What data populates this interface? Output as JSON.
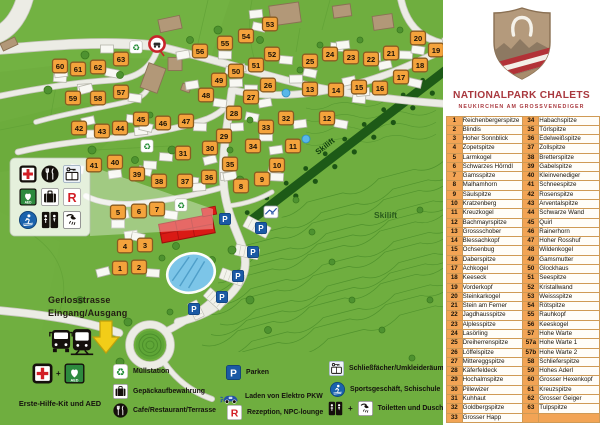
{
  "panel": {
    "title": "NATIONALPARK CHALETS",
    "subtitle": "NEUKIRCHEN AM GROSSVENEDIGER",
    "chalet_table": {
      "rows": [
        [
          "1",
          "Reichenbergerspitze",
          "34",
          "Habachspitze"
        ],
        [
          "2",
          "Blindis",
          "35",
          "Törlspitze"
        ],
        [
          "3",
          "Hoher Sonnblick",
          "36",
          "Edelweißspitze"
        ],
        [
          "4",
          "Zopetspitze",
          "37",
          "Zollspitze"
        ],
        [
          "5",
          "Larmkogel",
          "38",
          "Bretterspitze"
        ],
        [
          "6",
          "Schwarzes Hörndl",
          "39",
          "Gabelspitze"
        ],
        [
          "7",
          "Gamsspitze",
          "40",
          "Kleinvenediger"
        ],
        [
          "8",
          "Malhamhorn",
          "41",
          "Schneespitze"
        ],
        [
          "9",
          "Säulspitze",
          "42",
          "Rosenspitze"
        ],
        [
          "10",
          "Kratzenberg",
          "43",
          "Arventalspitze"
        ],
        [
          "11",
          "Kreuzkogel",
          "44",
          "Schwarze Wand"
        ],
        [
          "12",
          "Bachmayrspitze",
          "45",
          "Quirl"
        ],
        [
          "13",
          "Grossschober",
          "46",
          "Rainerhorn"
        ],
        [
          "14",
          "Blessachkopf",
          "47",
          "Hoher Rosshuf"
        ],
        [
          "15",
          "Ochsenbug",
          "48",
          "Wildenkogel"
        ],
        [
          "16",
          "Daberspitze",
          "49",
          "Gamsmutter"
        ],
        [
          "17",
          "Achkogel",
          "50",
          "Glockhaus"
        ],
        [
          "18",
          "Keeseck",
          "51",
          "Seespitze"
        ],
        [
          "19",
          "Vorderkopf",
          "52",
          "Kristallwand"
        ],
        [
          "20",
          "Steinkarkogel",
          "53",
          "Weissspitze"
        ],
        [
          "21",
          "Stein am Ferner",
          "54",
          "Rötspitze"
        ],
        [
          "22",
          "Jagdhausspitze",
          "55",
          "Rauhkopf"
        ],
        [
          "23",
          "Alplesspitze",
          "56",
          "Keeskogel"
        ],
        [
          "24",
          "Lasörling",
          "57",
          "Hohe Warte"
        ],
        [
          "25",
          "Dreiherrenspitze",
          "57a",
          "Hohe Warte 1"
        ],
        [
          "26",
          "Löffelspitze",
          "57b",
          "Hohe Warte 2"
        ],
        [
          "27",
          "Mittereggspitze",
          "58",
          "Schlieferspitze"
        ],
        [
          "28",
          "Käferfeldeck",
          "59",
          "Hohes Aderl"
        ],
        [
          "29",
          "Hochalmspitze",
          "60",
          "Grosser Hexenkopf"
        ],
        [
          "30",
          "Pillewizer",
          "61",
          "Kreuzspitze"
        ],
        [
          "31",
          "Kuhhaut",
          "62",
          "Grosser Geiger"
        ],
        [
          "32",
          "Goldbergspitze",
          "63",
          "Tulpspitze"
        ],
        [
          "33",
          "Grosser Happ",
          "",
          ""
        ]
      ]
    }
  },
  "map": {
    "labels": {
      "street": "Gerlosstrasse",
      "entrance": "Eingang/Ausgang",
      "skilift_band": "Skilift",
      "skilift_hill": "Skilift"
    },
    "markers": [
      {
        "n": "1",
        "x": 120,
        "y": 268
      },
      {
        "n": "2",
        "x": 139,
        "y": 267
      },
      {
        "n": "3",
        "x": 145,
        "y": 245
      },
      {
        "n": "4",
        "x": 125,
        "y": 246
      },
      {
        "n": "5",
        "x": 118,
        "y": 212
      },
      {
        "n": "6",
        "x": 139,
        "y": 211
      },
      {
        "n": "7",
        "x": 157,
        "y": 209
      },
      {
        "n": "8",
        "x": 241,
        "y": 186
      },
      {
        "n": "9",
        "x": 262,
        "y": 179
      },
      {
        "n": "10",
        "x": 277,
        "y": 165
      },
      {
        "n": "11",
        "x": 293,
        "y": 146
      },
      {
        "n": "12",
        "x": 327,
        "y": 118
      },
      {
        "n": "13",
        "x": 310,
        "y": 89
      },
      {
        "n": "14",
        "x": 336,
        "y": 90
      },
      {
        "n": "15",
        "x": 359,
        "y": 87
      },
      {
        "n": "16",
        "x": 380,
        "y": 88
      },
      {
        "n": "17",
        "x": 401,
        "y": 77
      },
      {
        "n": "18",
        "x": 420,
        "y": 65
      },
      {
        "n": "19",
        "x": 436,
        "y": 50
      },
      {
        "n": "20",
        "x": 418,
        "y": 38
      },
      {
        "n": "21",
        "x": 391,
        "y": 53
      },
      {
        "n": "22",
        "x": 371,
        "y": 59
      },
      {
        "n": "23",
        "x": 351,
        "y": 57
      },
      {
        "n": "24",
        "x": 330,
        "y": 54
      },
      {
        "n": "25",
        "x": 310,
        "y": 61
      },
      {
        "n": "26",
        "x": 268,
        "y": 85
      },
      {
        "n": "27",
        "x": 251,
        "y": 97
      },
      {
        "n": "28",
        "x": 234,
        "y": 113
      },
      {
        "n": "29",
        "x": 224,
        "y": 136
      },
      {
        "n": "30",
        "x": 210,
        "y": 148
      },
      {
        "n": "31",
        "x": 183,
        "y": 153
      },
      {
        "n": "32",
        "x": 286,
        "y": 118
      },
      {
        "n": "33",
        "x": 266,
        "y": 127
      },
      {
        "n": "34",
        "x": 253,
        "y": 146
      },
      {
        "n": "35",
        "x": 230,
        "y": 164
      },
      {
        "n": "36",
        "x": 209,
        "y": 177
      },
      {
        "n": "37",
        "x": 185,
        "y": 181
      },
      {
        "n": "38",
        "x": 159,
        "y": 181
      },
      {
        "n": "39",
        "x": 137,
        "y": 174
      },
      {
        "n": "40",
        "x": 115,
        "y": 162
      },
      {
        "n": "41",
        "x": 94,
        "y": 165
      },
      {
        "n": "42",
        "x": 79,
        "y": 128
      },
      {
        "n": "43",
        "x": 102,
        "y": 131
      },
      {
        "n": "44",
        "x": 120,
        "y": 128
      },
      {
        "n": "45",
        "x": 141,
        "y": 119
      },
      {
        "n": "46",
        "x": 163,
        "y": 123
      },
      {
        "n": "47",
        "x": 186,
        "y": 121
      },
      {
        "n": "48",
        "x": 206,
        "y": 95
      },
      {
        "n": "49",
        "x": 219,
        "y": 80
      },
      {
        "n": "50",
        "x": 236,
        "y": 71
      },
      {
        "n": "51",
        "x": 256,
        "y": 65
      },
      {
        "n": "52",
        "x": 272,
        "y": 54
      },
      {
        "n": "53",
        "x": 270,
        "y": 24
      },
      {
        "n": "54",
        "x": 246,
        "y": 36
      },
      {
        "n": "55",
        "x": 225,
        "y": 43
      },
      {
        "n": "56",
        "x": 200,
        "y": 51
      },
      {
        "n": "57",
        "x": 121,
        "y": 92
      },
      {
        "n": "58",
        "x": 98,
        "y": 98
      },
      {
        "n": "59",
        "x": 73,
        "y": 98
      },
      {
        "n": "60",
        "x": 60,
        "y": 66
      },
      {
        "n": "61",
        "x": 78,
        "y": 69
      },
      {
        "n": "62",
        "x": 98,
        "y": 67
      },
      {
        "n": "63",
        "x": 121,
        "y": 59
      }
    ],
    "poi": {
      "recycle": [
        [
          136,
          47
        ],
        [
          147,
          146
        ],
        [
          181,
          205
        ]
      ],
      "parking": [
        [
          225,
          219
        ],
        [
          261,
          228
        ],
        [
          253,
          252
        ],
        [
          238,
          276
        ],
        [
          222,
          297
        ],
        [
          194,
          309
        ]
      ],
      "skilift_station": [
        271,
        212
      ],
      "traffic_sign": [
        157,
        44
      ],
      "bus": [
        61,
        341
      ],
      "train": [
        82,
        342
      ],
      "entrance_arrow": [
        106,
        337
      ]
    },
    "facilities_box": {
      "icons": [
        [
          "first-aid",
          "restaurant",
          "lockers"
        ],
        [
          "aed",
          "luggage",
          "reception"
        ],
        [
          "ski-school",
          "wc",
          "shower"
        ]
      ]
    }
  },
  "legend": {
    "plus": "+",
    "first_aid": {
      "label": "Erste-Hilfe-Kit und AED",
      "icons": [
        "first-aid",
        "aed"
      ]
    },
    "items": [
      {
        "icon": "recycle",
        "label": "Müllstation"
      },
      {
        "icon": "luggage",
        "label": "Gepäckaufbewahrung"
      },
      {
        "icon": "restaurant",
        "label": "Cafe/Restaurant/Terrasse"
      },
      {
        "icon": "parking",
        "label": "Parken"
      },
      {
        "icon": "ev-charging",
        "label": "Laden von Elektro PKW"
      },
      {
        "icon": "reception",
        "label": "Rezeption, NPC-lounge"
      },
      {
        "icon": "lockers",
        "label": "Schließfächer/Umkleideräume"
      },
      {
        "icon": "ski-school",
        "label": "Sportsgeschäft, Schischule"
      },
      {
        "icon": "toilets-showers",
        "label": "Toiletten und Duschen"
      }
    ]
  },
  "icons_text": {
    "aed": "AED",
    "parking": "P",
    "reception": "R"
  },
  "colors": {
    "map_green": "#6fae3f",
    "marker_orange": "#f4a33c",
    "marker_border": "#8a5c20",
    "accent_red": "#a9383e",
    "table_orange": "#f2a455",
    "parking_blue": "#1b5aa5",
    "pool_blue": "#7cc5e8",
    "building_red": "#d91a15",
    "slope_dark_green": "#1d5a17"
  }
}
